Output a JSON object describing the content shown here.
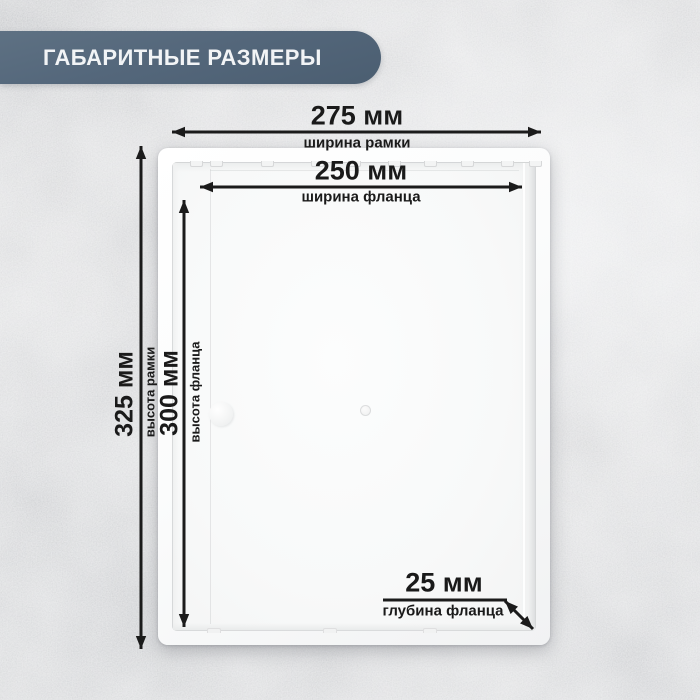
{
  "banner": {
    "title": "ГАБАРИТНЫЕ РАЗМЕРЫ"
  },
  "dims": {
    "frame_width": {
      "value": "275 мм",
      "label": "ширина рамки"
    },
    "flange_width": {
      "value": "250 мм",
      "label": "ширина фланца"
    },
    "frame_height": {
      "value": "325 мм",
      "label": "высота рамки"
    },
    "flange_height": {
      "value": "300 мм",
      "label": "высота фланца"
    },
    "flange_depth": {
      "value": "25 мм",
      "label": "глубина фланца"
    }
  },
  "colors": {
    "banner_bg": "#54677b",
    "banner_text": "#f2f4f6",
    "dimension_ink": "#1b1b1b",
    "panel_white": "#fafbfb",
    "background_gray": "#d7d8da"
  }
}
